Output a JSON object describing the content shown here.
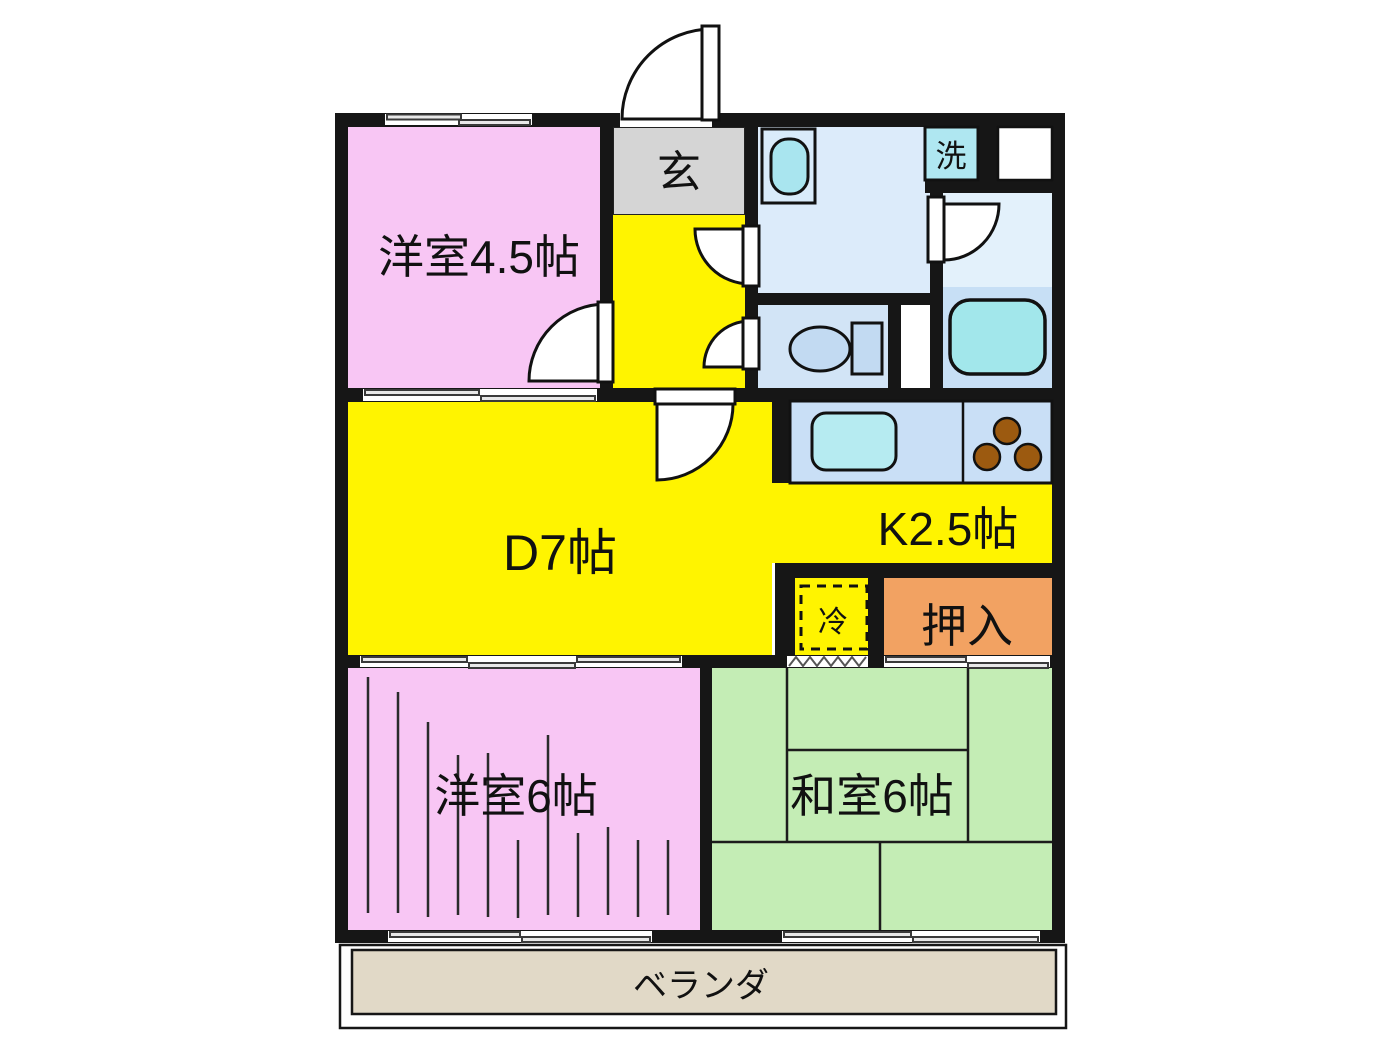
{
  "plan": {
    "type": "apartment-floor-plan",
    "rooms": {
      "western_room_top": {
        "label": "洋室4.5帖"
      },
      "genkan": {
        "label": "玄"
      },
      "laundry": {
        "label": "洗"
      },
      "dining": {
        "label": "D7帖"
      },
      "kitchen": {
        "label": "K2.5帖"
      },
      "refrigerator": {
        "label": "冷"
      },
      "closet": {
        "label": "押入"
      },
      "western_room_bottom": {
        "label": "洋室6帖"
      },
      "japanese_room": {
        "label": "和室6帖"
      },
      "veranda": {
        "label": "ベランダ"
      }
    },
    "colors": {
      "wall": "#161616",
      "western_room": "#F8C6F4",
      "yellow_area": "#FFF400",
      "genkan": "#D5D5D5",
      "washroom": "#DCEBFA",
      "laundry_box": "#AFE7F1",
      "toilet_room": "#D2E4F6",
      "toilet_fixture": "#C2DAF2",
      "bath_upper": "#E3F1FB",
      "bath_lower": "#C7DFF5",
      "bathtub": "#A2E7EB",
      "counter": "#C9DFF6",
      "counter_sink": "#B6EBF1",
      "stove": "#9C5A10",
      "sink_bowl": "#A9E5EF",
      "closet": "#F2A262",
      "japanese_room": "#C4EDB5",
      "veranda": "#E1D9C7"
    }
  }
}
